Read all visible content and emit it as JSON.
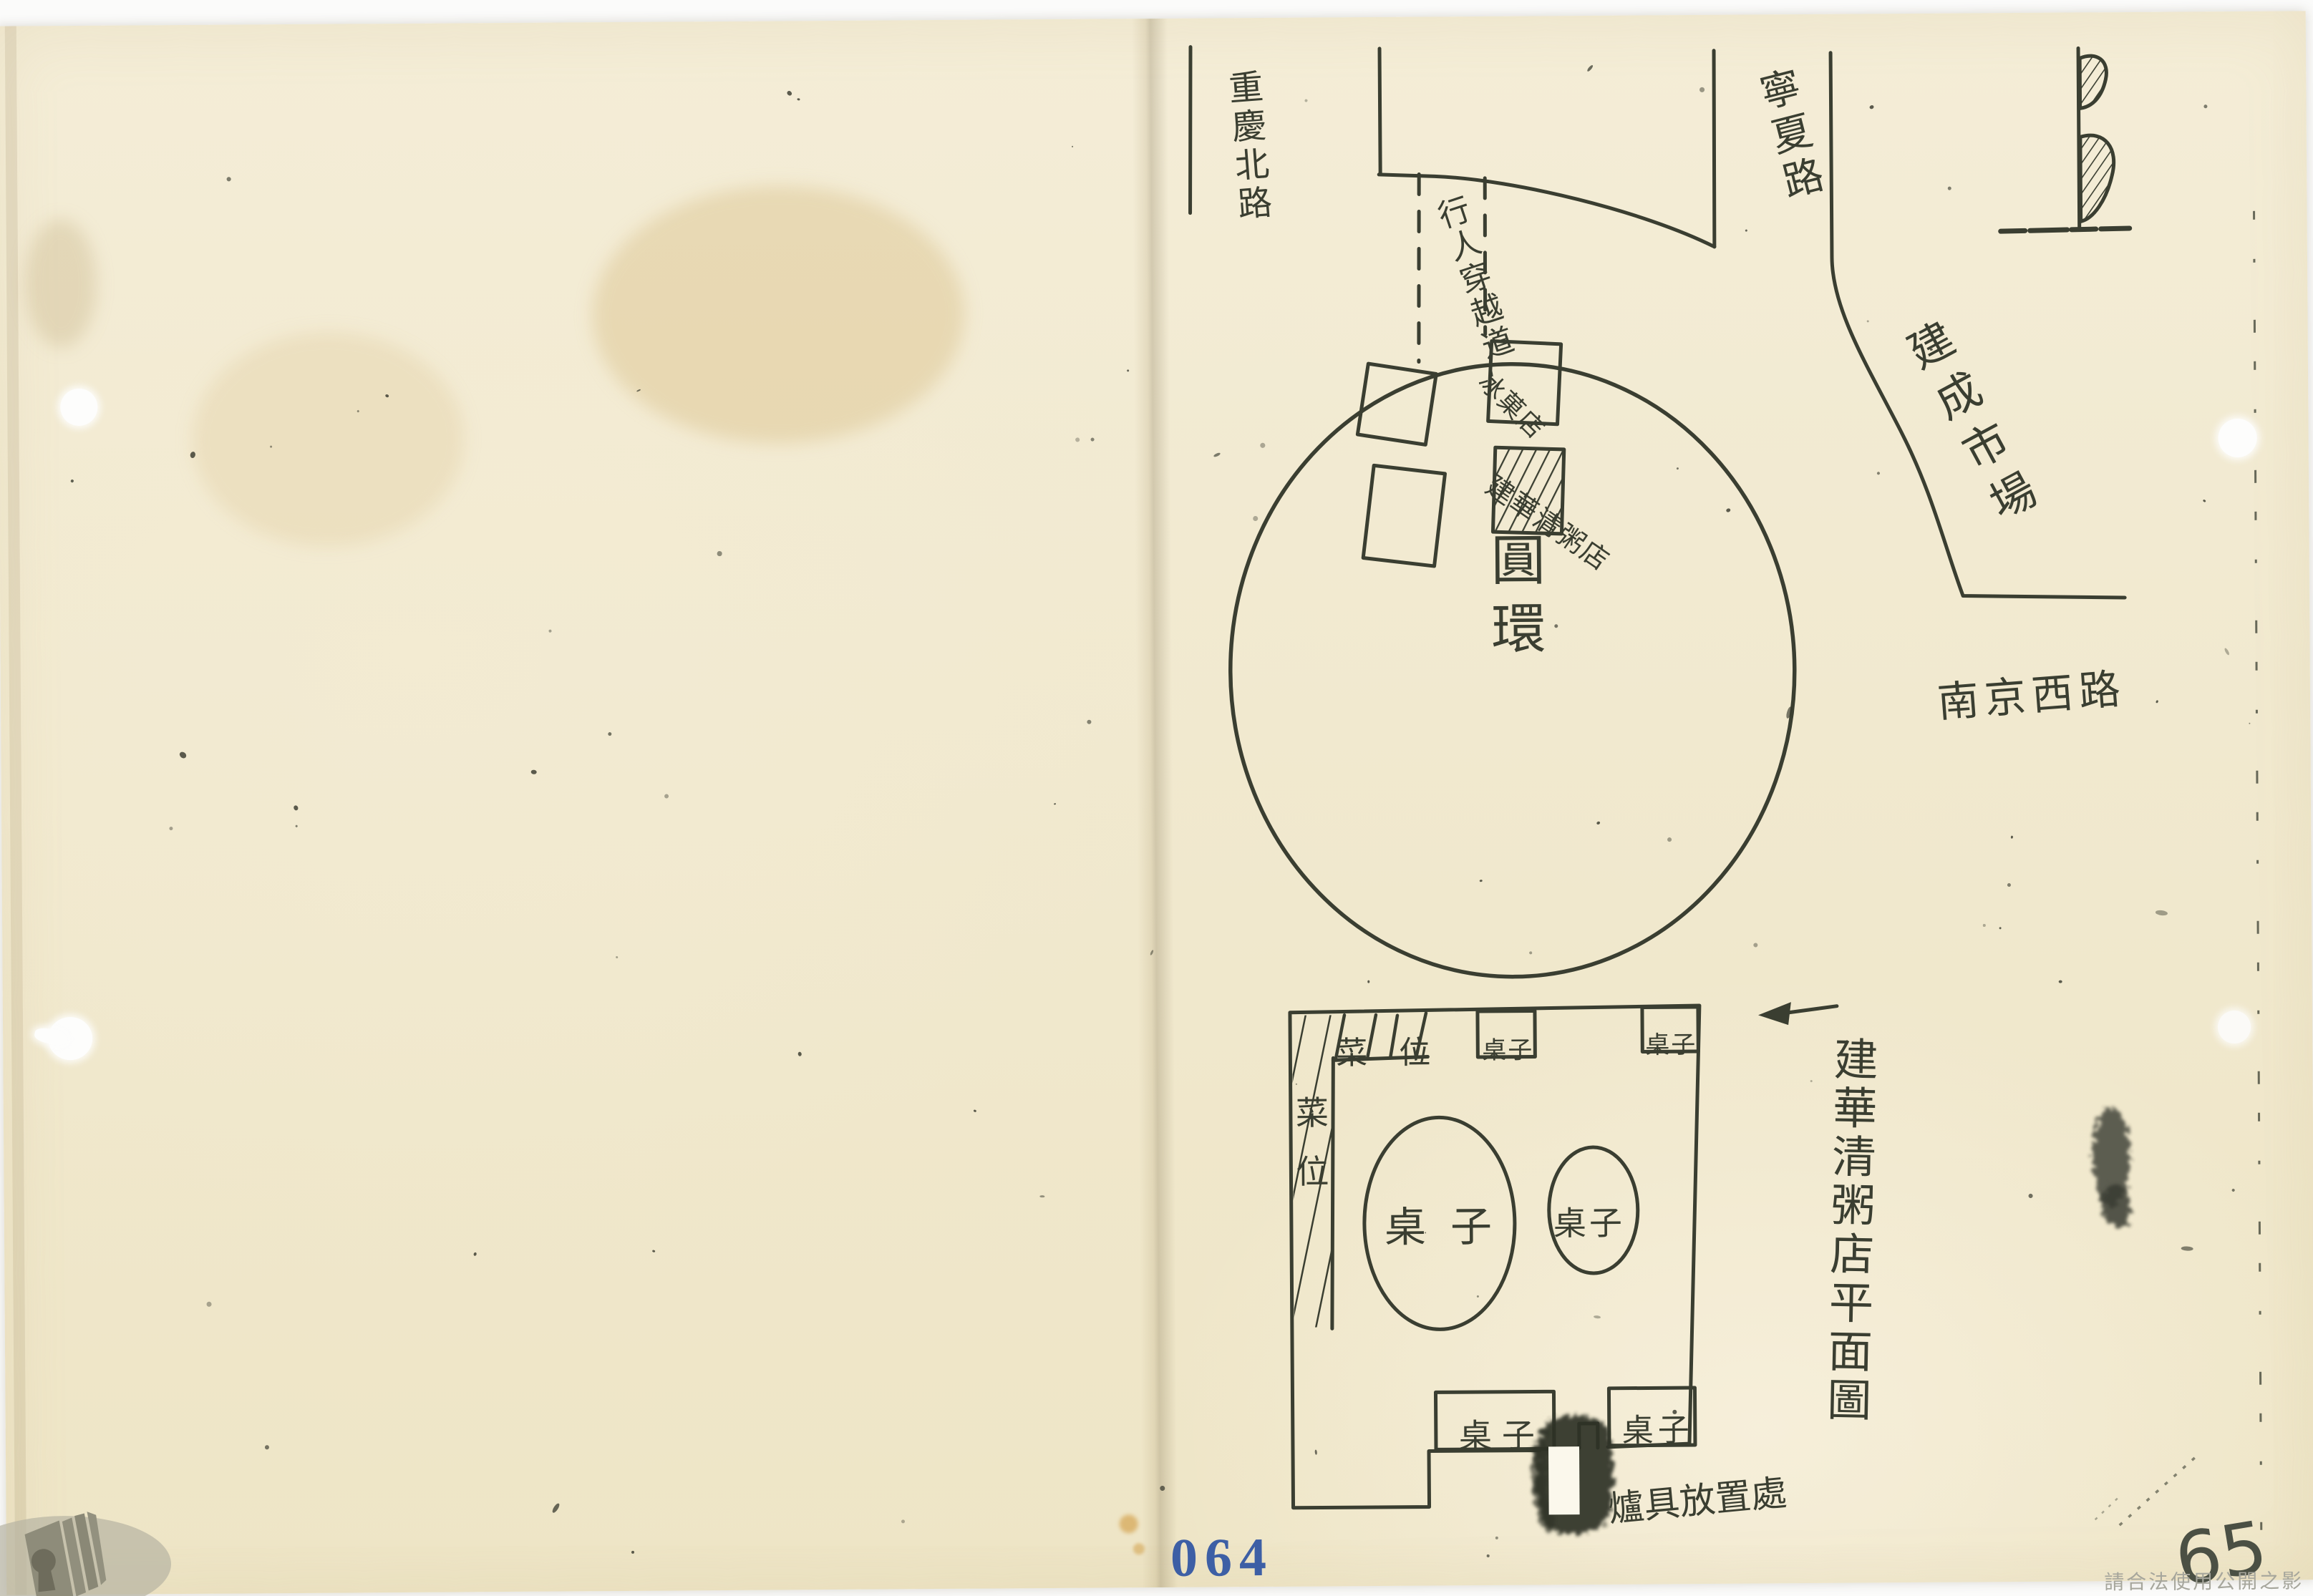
{
  "map": {
    "roads": {
      "chongqing_north": "重慶北路",
      "ningxia": "寧夏路",
      "jiancheng_market": "建成市場",
      "nanjing_west": "南京西路"
    },
    "pedestrian_crossing": "行人穿越道",
    "roundabout": "圓環",
    "shops": {
      "ice_fruit": "冰菓店",
      "congee": "建華清粥店"
    }
  },
  "plan": {
    "caption": "建華清粥店平面圖",
    "stall_top": "菜位",
    "stall_left": "菜位",
    "tables": [
      "桌子",
      "桌子",
      "桌子",
      "桌子",
      "桌子",
      "桌子"
    ],
    "stove_note": "爐具放置處"
  },
  "footer": {
    "page_stamp": "064",
    "page_handwritten": "65",
    "watermark": "請合法使用公開之影像"
  },
  "colors": {
    "ink": "#3a3e31",
    "paper": "#f1e9cf",
    "stamp_blue": "#3d5fa5"
  }
}
